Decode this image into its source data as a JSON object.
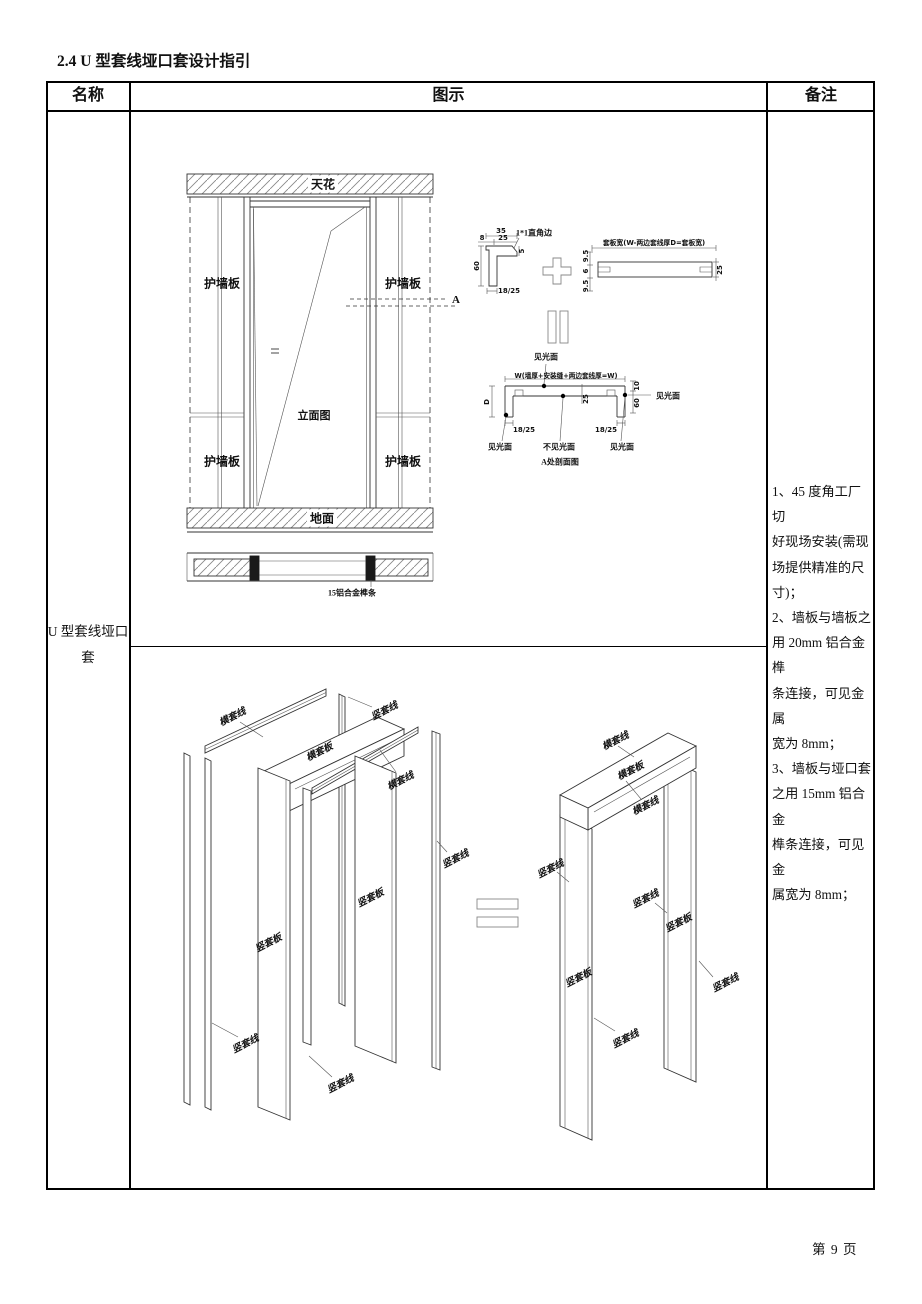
{
  "page": {
    "title": "2.4 U 型套线垭口套设计指引",
    "footer": "第 9 页"
  },
  "table": {
    "header": {
      "name": "名称",
      "diagram": "图示",
      "notes": "备注"
    },
    "name_cell": {
      "line1": "U 型套线垭口",
      "line2": "套"
    },
    "notes_lines": [
      "1、45 度角工厂切",
      "好现场安装(需现",
      "场提供精准的尺",
      "寸)；",
      "2、墙板与墙板之",
      "用 20mm 铝合金榫",
      "条连接，可见金属",
      "宽为 8mm；",
      "3、墙板与垭口套",
      "之用 15mm 铝合金",
      "榫条连接，可见金",
      "属宽为 8mm；"
    ]
  },
  "elevation": {
    "ceiling": "天花",
    "floor": "地面",
    "wall_panel": "护墙板",
    "view_title": "立面图",
    "section_mark": "A",
    "plan_note": "15铝合金榫条"
  },
  "details": {
    "corner_profile": {
      "dim_top": "35",
      "dim_8": "8",
      "dim_25": "25",
      "chamfer": "1*1直角边",
      "dim_5": "5",
      "dim_60": "60",
      "dim_bottom": "18/25"
    },
    "plank_profile": {
      "title": "套板宽(W-两边套线厚D=套板宽)",
      "dim_9_5_top": "9.5",
      "dim_6": "6",
      "dim_9_5_bottom": "9.5",
      "dim_25": "25"
    },
    "section_a": {
      "visible_top": "见光面",
      "width_formula": "W(墙厚+安装缝+两边套线厚=W)",
      "dim_d": "D",
      "dim_25": "25",
      "dim_10": "10",
      "dim_60": "60",
      "dim_18_25_left": "18/25",
      "dim_18_25_right": "18/25",
      "visible_right": "见光面",
      "visible_bottom_left": "见光面",
      "not_visible_bottom": "不见光面",
      "visible_bottom_right": "见光面",
      "caption": "A处剖面图"
    }
  },
  "exploded": {
    "left_labels": [
      "横套线",
      "竖套线",
      "横套板",
      "横套线",
      "竖套线",
      "竖套板",
      "竖套板",
      "竖套线",
      "竖套线"
    ],
    "right_labels": [
      "横套线",
      "横套板",
      "横套线",
      "竖套线",
      "竖套线",
      "竖套板",
      "竖套板",
      "竖套线",
      "竖套线"
    ]
  }
}
